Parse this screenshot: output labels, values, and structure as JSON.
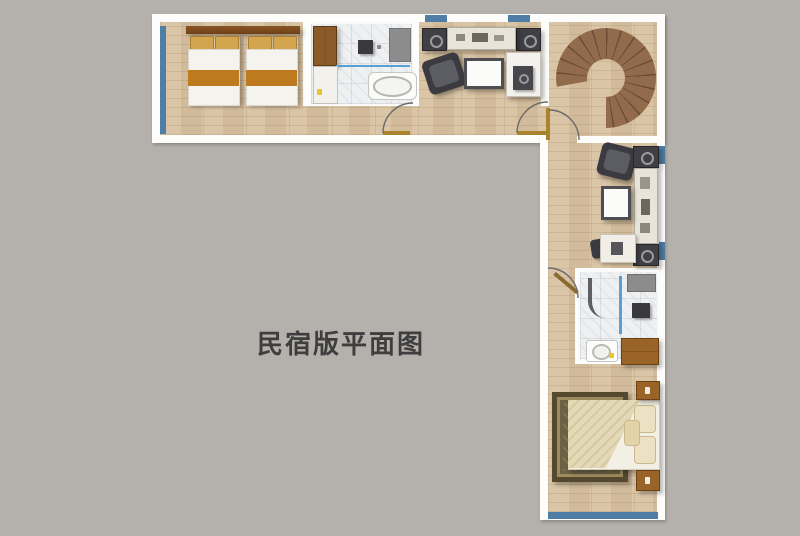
{
  "title": {
    "text": "民宿版平面图"
  },
  "palette": {
    "background": "#b4b0ac",
    "wall": "#fdfdfc",
    "wood_floor": "#d8c2a1",
    "tile_floor": "#eef0f1",
    "window_blue": "#4f7da6",
    "door_gold": "#a8842c",
    "stair_brown": "#8f674b",
    "blanket_orange": "#bd7a1e",
    "pillow_tan": "#d4a54f",
    "rug_olive": "#6d6144",
    "duvet_cream": "#e4d9b7",
    "title_text": "#3e3e3e"
  },
  "plan": {
    "shape": "L-shaped guesthouse floor plan, top wing horizontal, right wing vertical",
    "rooms": [
      "twin-bedroom (top-left, two single beds with orange blankets)",
      "bathroom-1 (top-center, wardrobe, shower, bathtub)",
      "living-area (top-right of horizontal wing, sofa chair, coffee table, media console)",
      "spiral-stair-hall (top-right corner, wooden spiral staircase)",
      "sitting-area (right wing upper, armchair, coffee table, side console, desk)",
      "bathroom-2 (right wing middle, shower, vanity, toilet)",
      "double-bedroom (right wing bottom, bed on olive rug, two nightstands)"
    ],
    "windows": [
      "left wall",
      "two on top wall",
      "two on right wall",
      "bottom wall"
    ],
    "doors": 4
  }
}
